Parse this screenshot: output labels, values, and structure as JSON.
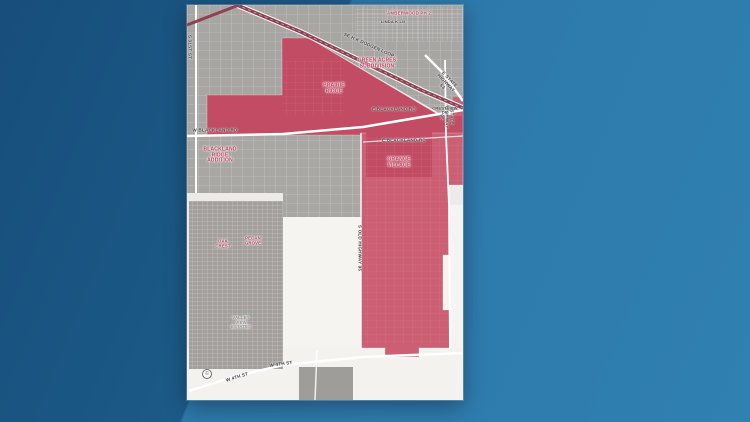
{
  "scene": {
    "description": "News graphic: city map with red highlighted annexation areas on blue background"
  },
  "colors": {
    "bg_blue_dark": "#1c5a88",
    "bg_blue_light": "#2d77a9",
    "map_base": "#ecebe8",
    "urban_gray": "#a8a6a3",
    "highlight_red": "#c24c63",
    "highlight_rose": "#cc5f74",
    "highway_red": "#8e4152",
    "road_white": "#ffffff",
    "area_label_red": "#bc3a54",
    "road_label_gray": "#3f4043"
  },
  "map": {
    "area_labels": [
      {
        "id": "green-acres",
        "text": "GREEN ACRES\nSUBDIVISION"
      },
      {
        "id": "prairie-ridge",
        "text": "PRAIRIE\nRIDGE"
      },
      {
        "id": "blackland-ridge",
        "text": "BLACKLAND\nRIDGE\nADDITION"
      },
      {
        "id": "grange-village",
        "text": "GRANGE\nVILLAGE"
      },
      {
        "id": "amberwood",
        "text": "AMBERWOOD PH 2"
      },
      {
        "id": "oak-crest",
        "text": "OAK\nCREST"
      },
      {
        "id": "pecan-grove",
        "text": "PECAN\nGROVE"
      },
      {
        "id": "valley-view",
        "text": "VALLEY\nVIEW\nESTATES"
      }
    ],
    "road_labels": [
      {
        "id": "w-blackland",
        "text": "W BLACKLAND RD"
      },
      {
        "id": "e-blackland-1",
        "text": "E BLACKLAND RD"
      },
      {
        "id": "e-blackland-2",
        "text": "E BLACKLAND RD"
      },
      {
        "id": "s-31st",
        "text": "S 31ST ST"
      },
      {
        "id": "dodgen-loop",
        "text": "SE H K DODGEN LOOP"
      },
      {
        "id": "sh53",
        "text": "E STATE HIGHWAY 53"
      },
      {
        "id": "sh95",
        "text": "STATE HIGHWAY 95"
      },
      {
        "id": "old95",
        "text": "S OLD HIGHWAY 95"
      },
      {
        "id": "w4th-1",
        "text": "W 4TH ST"
      },
      {
        "id": "w4th-2",
        "text": "W 4TH ST"
      },
      {
        "id": "crestview",
        "text": "CRESTVIEW DR"
      },
      {
        "id": "linda-ln",
        "text": "LINDA K LN"
      }
    ],
    "attribution": "©"
  }
}
